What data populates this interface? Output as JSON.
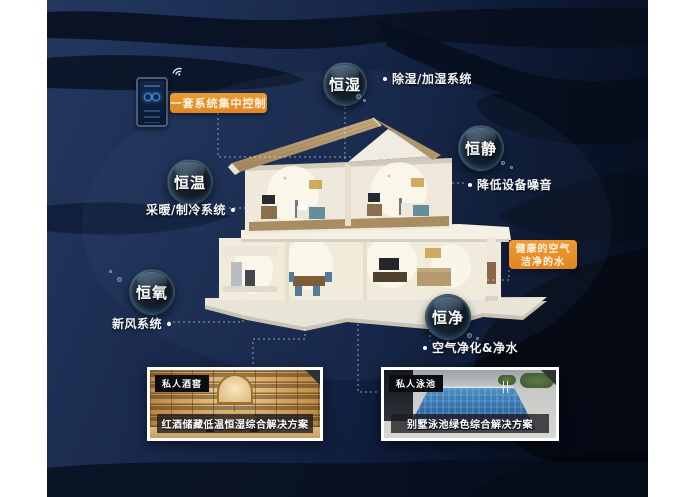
{
  "poster": {
    "theme_colors": {
      "background_navy": "#16284a",
      "wave_dark": "#070f1f",
      "accent_orange": "#e8912c",
      "bubble_rim_blue": "#7fb6e8"
    }
  },
  "icons": {
    "phone": "smart-control-phone-icon",
    "wifi": "wifi-signal-icon",
    "corner_fold": "corner-fold-icon",
    "connectors": "dashed-connector-lines"
  },
  "control": {
    "label": "一套系统集中控制"
  },
  "features": [
    {
      "name": "恒湿",
      "system": "除湿/加湿系统"
    },
    {
      "name": "恒静",
      "system": "降低设备噪音"
    },
    {
      "name": "恒温",
      "system": "采暖/制冷系统"
    },
    {
      "name": "恒氧",
      "system": "新风系统"
    },
    {
      "name": "恒净",
      "system": "空气净化&净水"
    }
  ],
  "benefit": {
    "line1": "健康的空气",
    "line2": "洁净的水"
  },
  "panels": [
    {
      "tag": "私人酒窖",
      "caption": "红酒储藏低温恒湿综合解决方案"
    },
    {
      "tag": "私人泳池",
      "caption": "别墅泳池绿色综合解决方案"
    }
  ]
}
